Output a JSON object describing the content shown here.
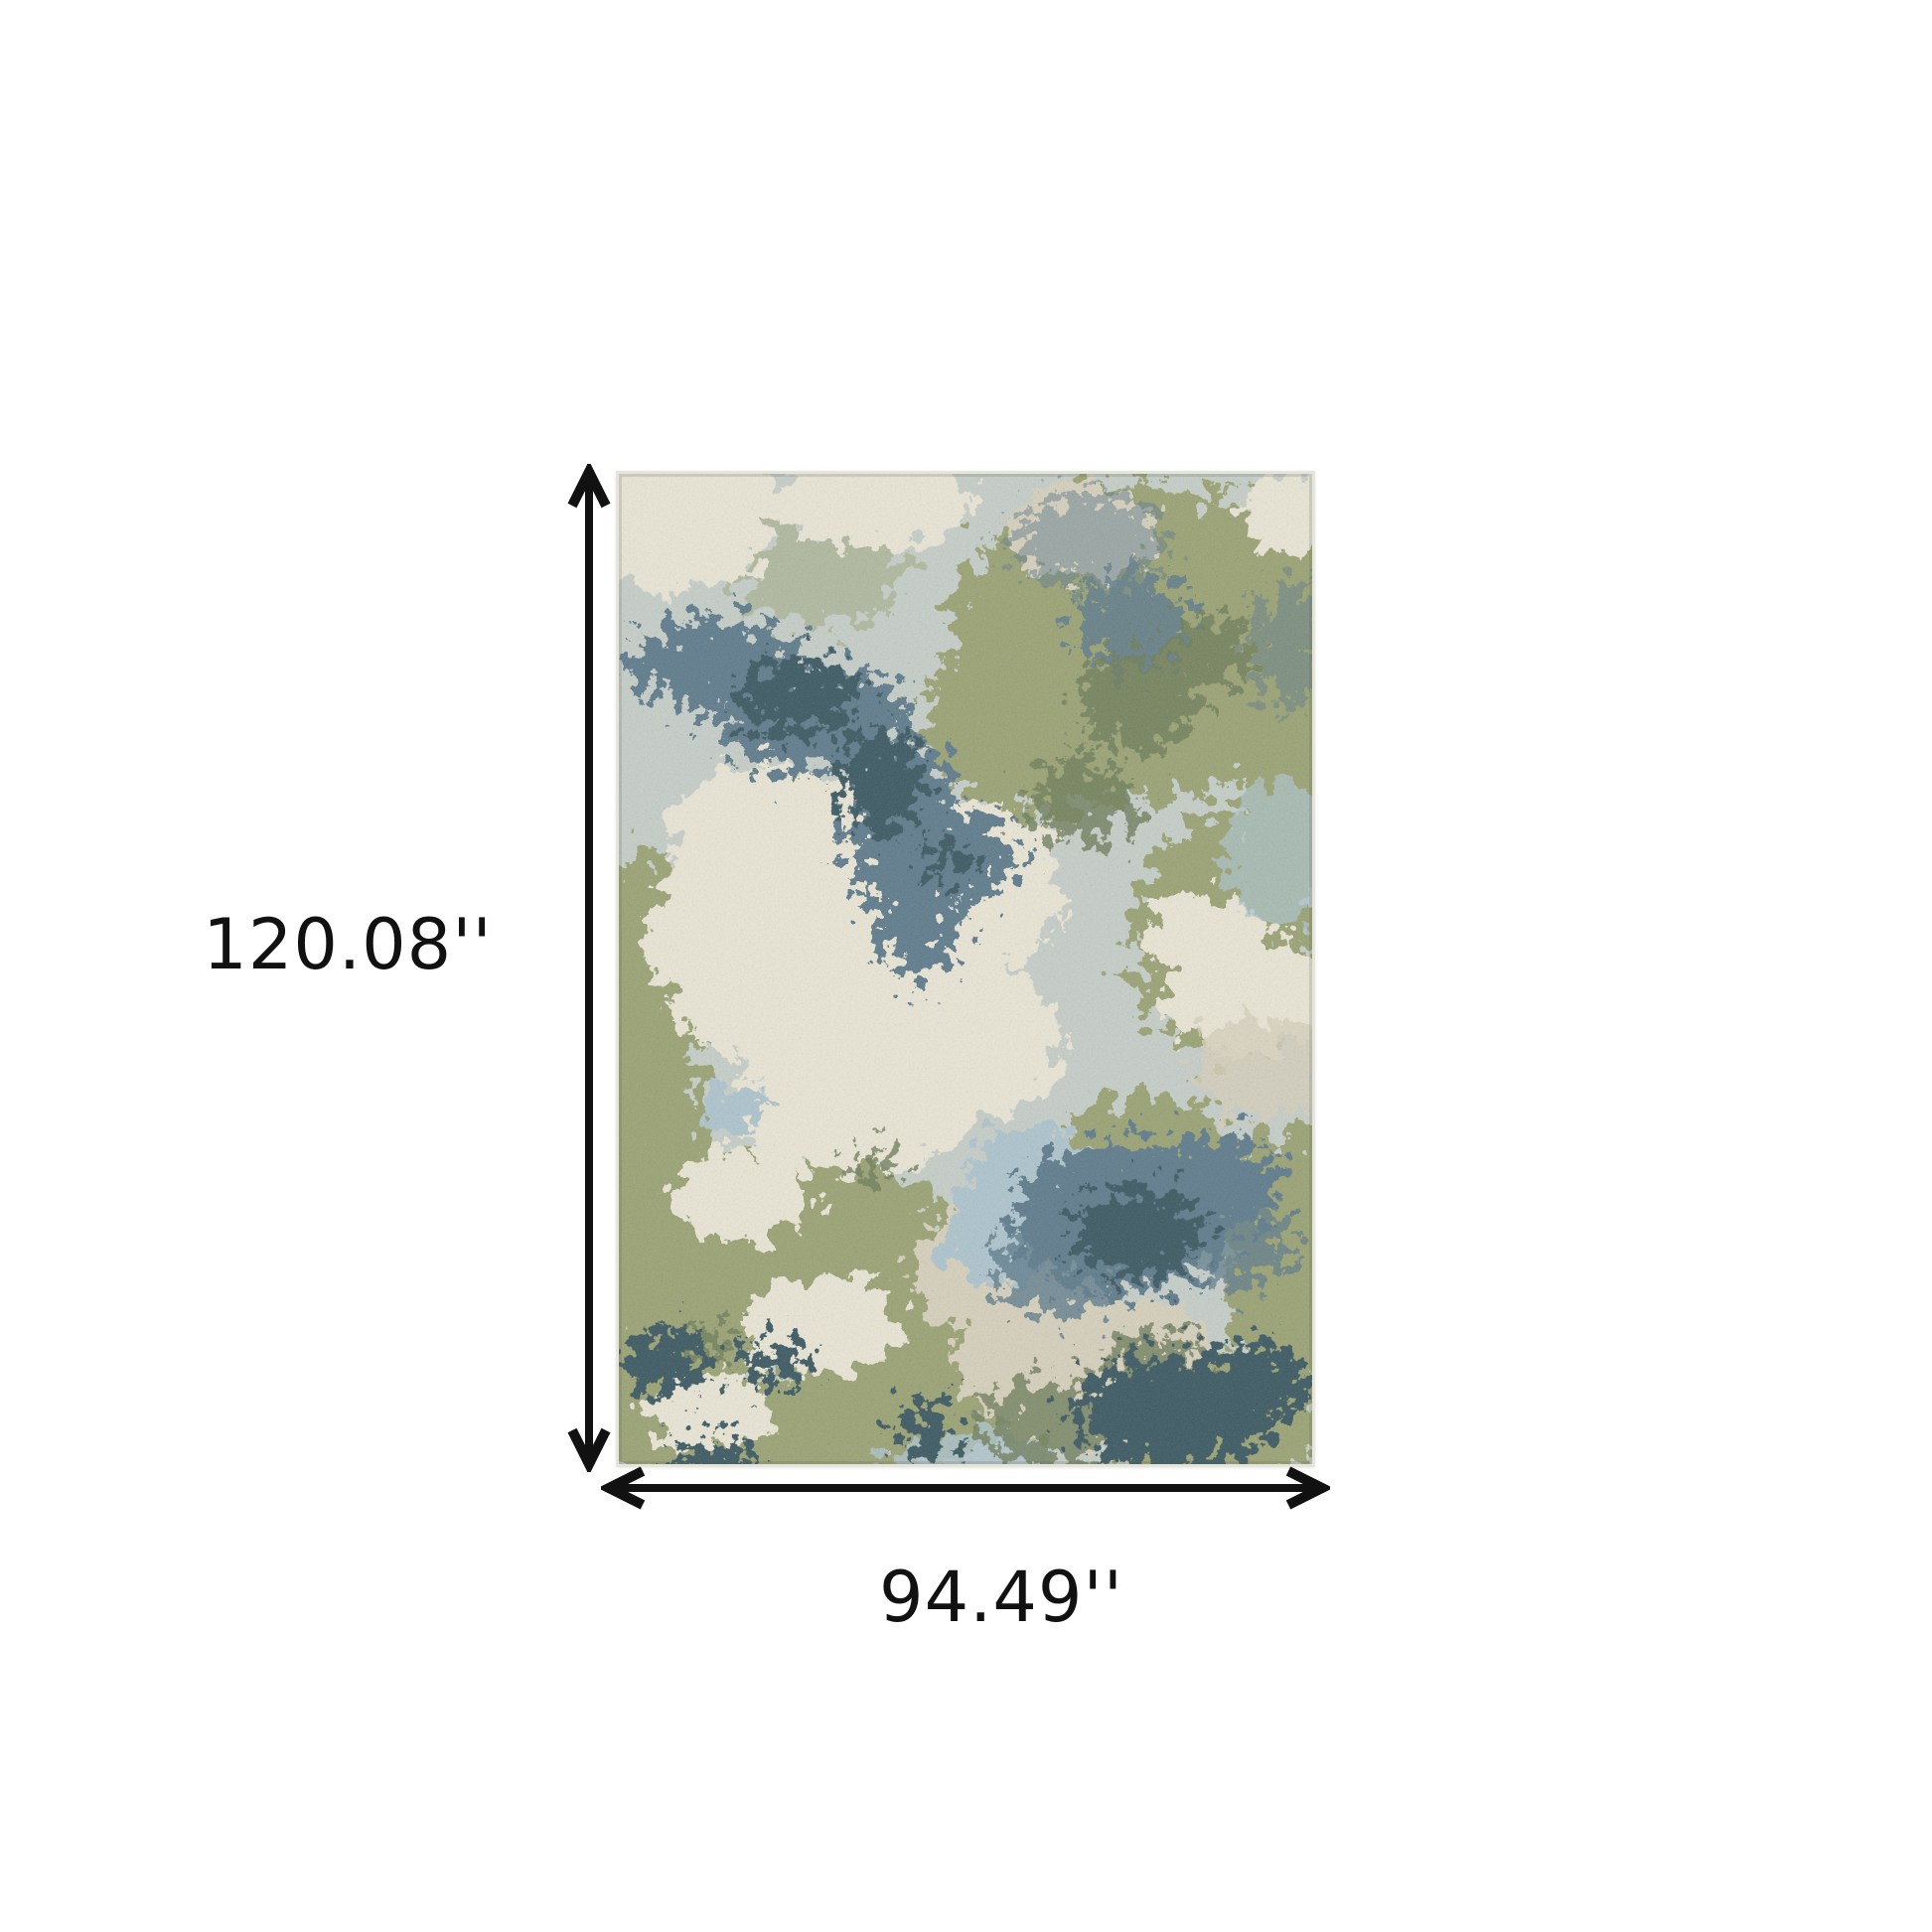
{
  "diagram": {
    "height_label": "120.08''",
    "width_label": "94.49''"
  },
  "colors": {
    "ink": "#111111",
    "canvas_bg": "#ffffff",
    "rug_edge": "#e6e5dc",
    "rug_base": "#c6cec8",
    "rug_green": "#9ba375",
    "rug_green_dark": "#6e7d5a",
    "rug_cream": "#e9e5d5",
    "rug_tan": "#d6d0bc",
    "rug_slate": "#5f7c8c",
    "rug_slate_dark": "#3e5a64",
    "rug_lightblue": "#aec4cd"
  }
}
